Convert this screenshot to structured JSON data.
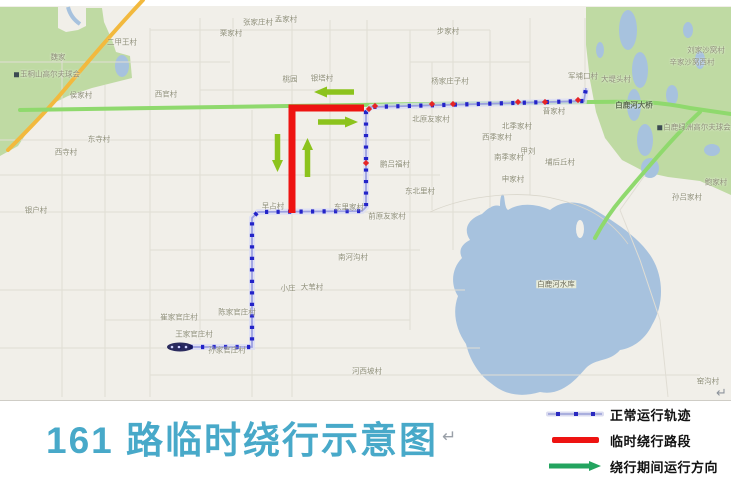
{
  "title": {
    "text": "161 路临时绕行示意图",
    "pilcrow": "↵"
  },
  "legend": {
    "items": [
      {
        "type": "normal-track",
        "label": "正常运行轨迹"
      },
      {
        "type": "detour-segment",
        "label": "临时绕行路段"
      },
      {
        "type": "detour-direction",
        "label": "绕行期间运行方向"
      }
    ]
  },
  "colors": {
    "map_bg": "#f1efe9",
    "water": "#a7c2de",
    "park": "#bfdaa3",
    "route_blue": "#2323c8",
    "route_line": "#9a9ee2",
    "detour_red": "#ee1311",
    "stop_red": "#e62525",
    "arrow_green": "#8cc31d",
    "legend_arrow_green": "#23a45f",
    "title_teal": "#48a9c9",
    "road_yellow": "#f2b93e",
    "road_green": "#8fd96d",
    "label_gray": "#8e8e78"
  },
  "map": {
    "pilcrow": "↵",
    "labels": [
      {
        "t": "二甲王村",
        "x": 122,
        "y": 42
      },
      {
        "t": "魏家",
        "x": 58,
        "y": 57
      },
      {
        "t": "玉桐山高尔夫球会",
        "x": 47,
        "y": 74,
        "icon": true
      },
      {
        "t": "侯家村",
        "x": 81,
        "y": 95
      },
      {
        "t": "西官村",
        "x": 166,
        "y": 94
      },
      {
        "t": "栗家村",
        "x": 231,
        "y": 33
      },
      {
        "t": "张家庄村",
        "x": 258,
        "y": 22
      },
      {
        "t": "孟家村",
        "x": 286,
        "y": 19
      },
      {
        "t": "步家村",
        "x": 448,
        "y": 31
      },
      {
        "t": "桃园",
        "x": 290,
        "y": 79
      },
      {
        "t": "银塔村",
        "x": 322,
        "y": 78
      },
      {
        "t": "杨家庄子村",
        "x": 450,
        "y": 81
      },
      {
        "t": "军埔口村",
        "x": 583,
        "y": 76
      },
      {
        "t": "大堤头村",
        "x": 616,
        "y": 79
      },
      {
        "t": "刘家沙窝村",
        "x": 706,
        "y": 50
      },
      {
        "t": "辛家沙窝西村",
        "x": 692,
        "y": 62
      },
      {
        "t": "晋家村",
        "x": 554,
        "y": 111
      },
      {
        "t": "北季家村",
        "x": 517,
        "y": 126
      },
      {
        "t": "北原友家村",
        "x": 431,
        "y": 119
      },
      {
        "t": "西季家村",
        "x": 497,
        "y": 137
      },
      {
        "t": "甲刘",
        "x": 528,
        "y": 151
      },
      {
        "t": "南季家村",
        "x": 509,
        "y": 157
      },
      {
        "t": "埔后丘村",
        "x": 560,
        "y": 162
      },
      {
        "t": "申家村",
        "x": 513,
        "y": 179
      },
      {
        "t": "鲍家村",
        "x": 716,
        "y": 182
      },
      {
        "t": "孙吕家村",
        "x": 687,
        "y": 197
      },
      {
        "t": "鹏吕福村",
        "x": 395,
        "y": 164
      },
      {
        "t": "东北里村",
        "x": 420,
        "y": 191
      },
      {
        "t": "东寺村",
        "x": 99,
        "y": 139
      },
      {
        "t": "西寺村",
        "x": 66,
        "y": 152
      },
      {
        "t": "银户村",
        "x": 36,
        "y": 210
      },
      {
        "t": "早占村",
        "x": 273,
        "y": 206
      },
      {
        "t": "东里家村",
        "x": 349,
        "y": 207
      },
      {
        "t": "前原友家村",
        "x": 387,
        "y": 216
      },
      {
        "t": "南河沟村",
        "x": 353,
        "y": 257
      },
      {
        "t": "小庄",
        "x": 288,
        "y": 288
      },
      {
        "t": "大苇村",
        "x": 312,
        "y": 287
      },
      {
        "t": "崔家官庄村",
        "x": 179,
        "y": 317
      },
      {
        "t": "陈家官庄村",
        "x": 237,
        "y": 312
      },
      {
        "t": "王家官庄村",
        "x": 194,
        "y": 334
      },
      {
        "t": "孙家官庄村",
        "x": 227,
        "y": 350
      },
      {
        "t": "河西坡村",
        "x": 367,
        "y": 371
      },
      {
        "t": "窑沟村",
        "x": 708,
        "y": 381
      },
      {
        "t": "白鹿河大桥",
        "x": 634,
        "y": 105,
        "cls": "on-road"
      },
      {
        "t": "白鹿绿洲高尔夫球会",
        "x": 694,
        "y": 127,
        "icon": true
      },
      {
        "t": "白鹿河水库",
        "x": 556,
        "y": 284,
        "cls": "on-water"
      }
    ]
  }
}
